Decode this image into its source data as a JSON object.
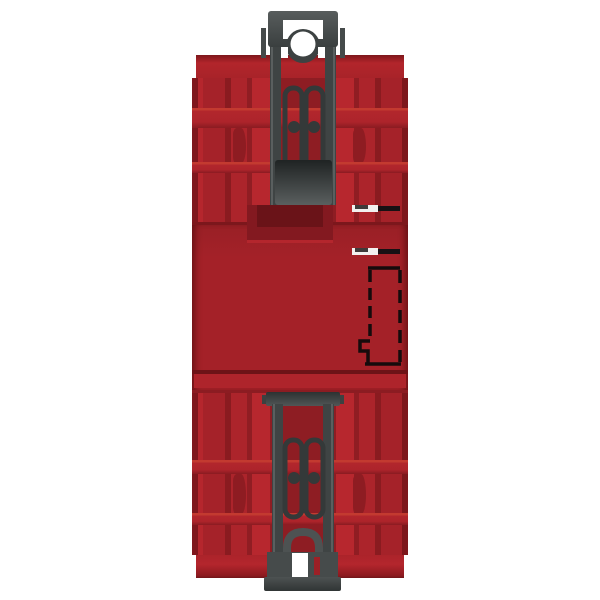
{
  "scene": {
    "type": "product-photo",
    "subject": "Rear view of a red DIN-rail industrial control module with two dark grey DIN-rail mounting clips",
    "background_color": "#ffffff"
  },
  "palette": {
    "body_red": "#a52229",
    "body_red_bright": "#b7272e",
    "body_red_dark": "#8a1b20",
    "body_red_shadow": "#6d1317",
    "channel_red": "#8e1d23",
    "clip_grey": "#4d5252",
    "clip_grey_dark": "#2f3434",
    "cutout_black": "#150b0c",
    "highlight_white": "#ffffff"
  },
  "parts": {
    "device": "red DIN-rail module, rear view",
    "top_clip": "top DIN-rail mounting clip",
    "bottom_clip": "bottom DIN-rail mounting clip with latch foot",
    "upper_housing": "upper finned housing section",
    "lower_housing": "lower finned housing section",
    "mid_panel": "smooth centre panel",
    "side_slot_upper": "upper side label slot",
    "side_slot_lower": "lower side label slot",
    "dashed_cutout": "dashed terminal cutout outline",
    "keyhole": "clip keyhole opening",
    "foot_opening": "clip foot opening"
  }
}
